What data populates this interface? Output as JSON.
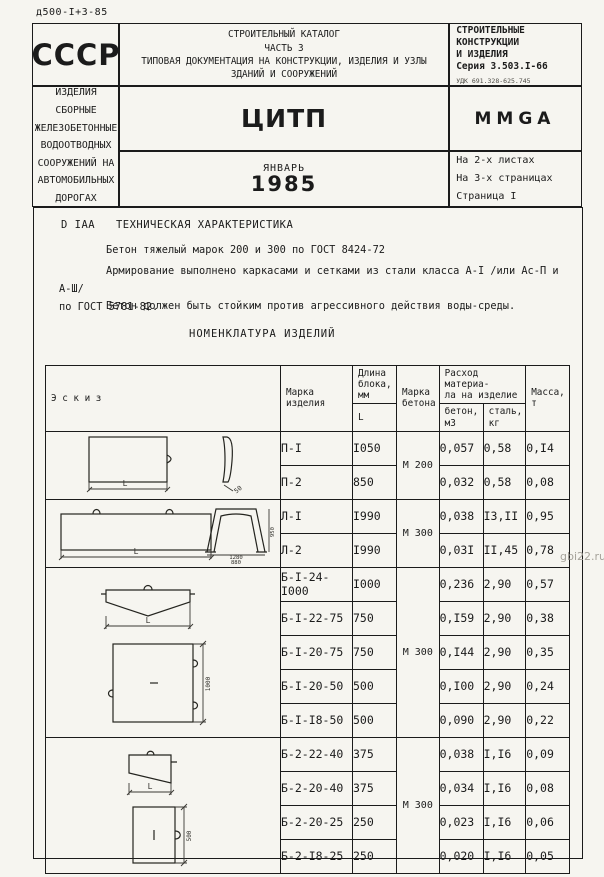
{
  "colors": {
    "ink": "#1b1b1b",
    "paper": "#f6f5f0",
    "watermark": "#a5a29a"
  },
  "page": {
    "doc_number": "д500-I+3-85",
    "watermark": "gbi22.ru"
  },
  "header": {
    "ussr": "СССР",
    "citp": "ЦИТП",
    "month": "ЯНВАРЬ",
    "year": "1985",
    "catalog": {
      "line1": "СТРОИТЕЛЬНЫЙ КАТАЛОГ",
      "line2": "ЧАСТЬ 3",
      "line3": "ТИПОВАЯ ДОКУМЕНТАЦИЯ НА КОНСТРУКЦИИ, ИЗДЕЛИЯ И УЗЛЫ",
      "line4": "ЗДАНИЙ И СООРУЖЕНИЙ"
    },
    "series": {
      "line1": "СТРОИТЕЛЬНЫЕ",
      "line2": "КОНСТРУКЦИИ",
      "line3": "И ИЗДЕЛИЯ",
      "line4": "Серия 3.503.I-66",
      "udk": "УДК 691.328-625.745"
    },
    "subject": {
      "line1": "ИЗДЕЛИЯ СБОРНЫЕ ЖЕЛЕЗОБЕТОННЫЕ ВОДООТВОДНЫХ",
      "line2": "СООРУЖЕНИЙ НА АВТОМОБИЛЬНЫХ ДОРОГАХ"
    },
    "stamp": "MMGA",
    "sheets": {
      "line1": "На 2-х листах",
      "line2": "На 3-х страницах",
      "line3": "Страница I"
    }
  },
  "tech": {
    "code": "D IAA",
    "title": "ТЕХНИЧЕСКАЯ ХАРАКТЕРИСТИКА",
    "para1": "Бетон тяжелый марок 200 и 300 по ГОСТ 8424-72",
    "para2": "Армирование выполнено каркасами и сетками из стали класса А-I /или Ас-П и А-Ш/\nпо ГОСТ 5781-82.",
    "para3": "Бетон должен быть  стойким против агрессивного действия воды-среды."
  },
  "nomenclature_title": "НОМЕНКЛАТУРА ИЗДЕЛИЙ",
  "table": {
    "headers": {
      "sketch": "Э с к и з",
      "mark": "Марка\nизделия",
      "length": "Длина\nблока,\nмм",
      "length_sub": "L",
      "concrete": "Марка\nбетона",
      "consumption": "Расход материа-\nла на изделие",
      "beton_sub": "бетон,\nм3",
      "steel_sub": "сталь,\nкг",
      "mass": "Масса,\nт"
    },
    "groups": [
      {
        "concrete": "М 200",
        "rows": [
          {
            "mark": "П-I",
            "len": "I050",
            "beton": "0,057",
            "steel": "0,58",
            "mass": "0,I4"
          },
          {
            "mark": "П-2",
            "len": "850",
            "beton": "0,032",
            "steel": "0,58",
            "mass": "0,08"
          }
        ]
      },
      {
        "concrete": "М 300",
        "rows": [
          {
            "mark": "Л-I",
            "len": "I990",
            "beton": "0,038",
            "steel": "I3,II",
            "mass": "0,95"
          },
          {
            "mark": "Л-2",
            "len": "I990",
            "beton": "0,03I",
            "steel": "II,45",
            "mass": "0,78"
          }
        ]
      },
      {
        "concrete": "М 300",
        "rows": [
          {
            "mark": "Б-I-24-I000",
            "len": "I000",
            "beton": "0,236",
            "steel": "2,90",
            "mass": "0,57"
          },
          {
            "mark": "Б-I-22-75",
            "len": "750",
            "beton": "0,I59",
            "steel": "2,90",
            "mass": "0,38"
          },
          {
            "mark": "Б-I-20-75",
            "len": "750",
            "beton": "0,I44",
            "steel": "2,90",
            "mass": "0,35"
          },
          {
            "mark": "Б-I-20-50",
            "len": "500",
            "beton": "0,I00",
            "steel": "2,90",
            "mass": "0,24"
          },
          {
            "mark": "Б-I-I8-50",
            "len": "500",
            "beton": "0,090",
            "steel": "2,90",
            "mass": "0,22"
          }
        ]
      },
      {
        "concrete": "М 300",
        "rows": [
          {
            "mark": "Б-2-22-40",
            "len": "375",
            "beton": "0,038",
            "steel": "I,I6",
            "mass": "0,09"
          },
          {
            "mark": "Б-2-20-40",
            "len": "375",
            "beton": "0,034",
            "steel": "I,I6",
            "mass": "0,08"
          },
          {
            "mark": "Б-2-20-25",
            "len": "250",
            "beton": "0,023",
            "steel": "I,I6",
            "mass": "0,06"
          },
          {
            "mark": "Б-2-I8-25",
            "len": "250",
            "beton": "0,020",
            "steel": "I,I6",
            "mass": "0,05"
          }
        ]
      }
    ],
    "sketch_dims": {
      "p": {
        "length": "L",
        "thickness": "50"
      },
      "l": {
        "length": "L",
        "width_top": "1280",
        "width_bottom": "880",
        "height": "950"
      },
      "b1": {
        "length": "L",
        "size": "1000"
      },
      "b2": {
        "length": "L",
        "height": "500"
      }
    }
  }
}
